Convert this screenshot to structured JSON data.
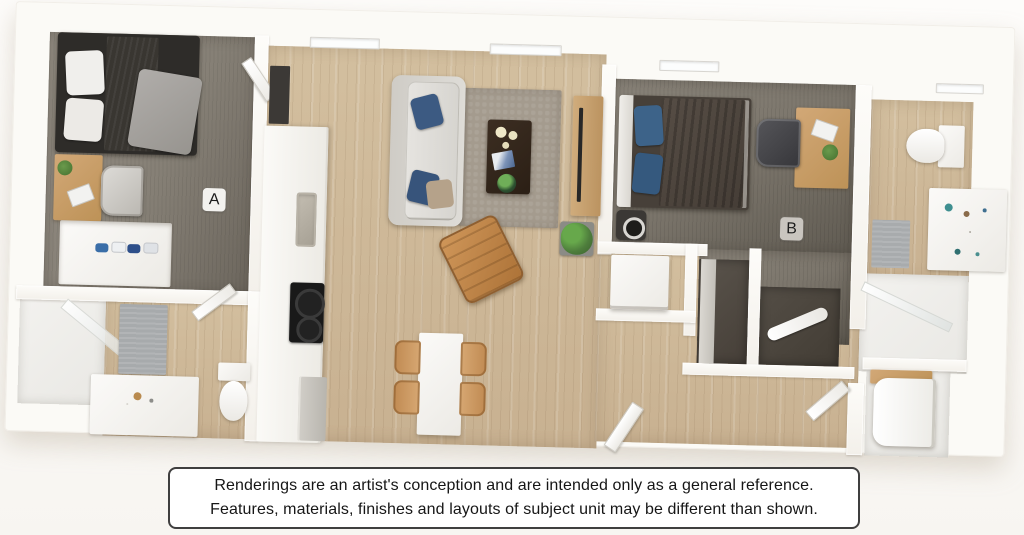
{
  "image": {
    "kind": "3d-floor-plan-rendering"
  },
  "floor_plan": {
    "labels": {
      "a": "A",
      "b": "B"
    }
  },
  "disclaimer": {
    "line1": "Renderings are an artist's conception and are intended only as a general reference.",
    "line2": "Features, materials, finishes and layouts of subject unit may be different than shown."
  },
  "colors": {
    "wall": "#fbfaf6",
    "wood_floor": "#ccb794",
    "carpet_bedroom_a": "#8b857b",
    "carpet_bedroom_b": "#7b756b",
    "bed_frame_dark": "#2e2c29",
    "duvet_gray": "#a3a09b",
    "duvet_brown": "#4d453e",
    "navy_pillow": "#3c5a82",
    "accent_chair_tan": "#bf8348",
    "desk_wood": "#c79d6a",
    "rug_taupe": "#a49b8e",
    "plant_green": "#4e7d3c",
    "disclaimer_border": "#3f3f3f"
  }
}
